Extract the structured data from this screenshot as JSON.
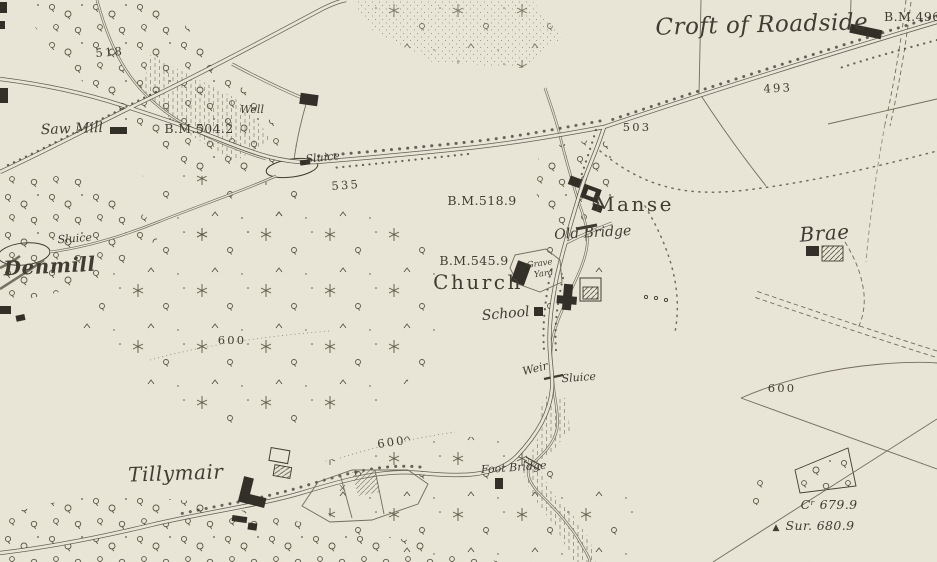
{
  "map": {
    "colors": {
      "paper": "#eae6d8",
      "ink": "#3c382e",
      "ink_faint": "#6f6a59",
      "vegetation": "#57533f",
      "water": "#6b675a",
      "building": "#2e2b24"
    },
    "icons": {
      "survey_triangle": "▲"
    },
    "labels": {
      "croft_of_roadside": {
        "text": "Croft of Roadside"
      },
      "bm_496": {
        "text": "B.M.496"
      },
      "spot_493": {
        "text": "493"
      },
      "spot_503": {
        "text": "503"
      },
      "spot_518": {
        "text": "518"
      },
      "spot_535": {
        "text": "535"
      },
      "saw_mill": {
        "text": "Saw Mill"
      },
      "bm_504_2": {
        "text": "B.M.504.2"
      },
      "well": {
        "text": "Well"
      },
      "sluice_pond": {
        "text": "Sluice"
      },
      "bm_518_9": {
        "text": "B.M.518.9"
      },
      "manse": {
        "text": "Manse"
      },
      "old_bridge": {
        "text": "Old Bridge"
      },
      "brae": {
        "text": "Brae"
      },
      "sluice_denmill": {
        "text": "Sluice"
      },
      "denmill": {
        "text": "Denmill"
      },
      "bm_545_9": {
        "text": "B.M.545.9"
      },
      "grave": {
        "text": "Grave"
      },
      "yard": {
        "text": "Yard"
      },
      "church": {
        "text": "Church"
      },
      "school": {
        "text": "School"
      },
      "weir": {
        "text": "Weir"
      },
      "sluice_weir": {
        "text": "Sluice"
      },
      "contour_600_west": {
        "text": "600"
      },
      "contour_600_south": {
        "text": "600"
      },
      "contour_600_east": {
        "text": "600"
      },
      "tillymair": {
        "text": "Tillymair"
      },
      "foot_bridge": {
        "text": "Foot Bridge"
      },
      "cr_679_9": {
        "text": "Cʳ 679.9"
      },
      "sur_680_9": {
        "text": "Sur. 680.9"
      }
    }
  }
}
